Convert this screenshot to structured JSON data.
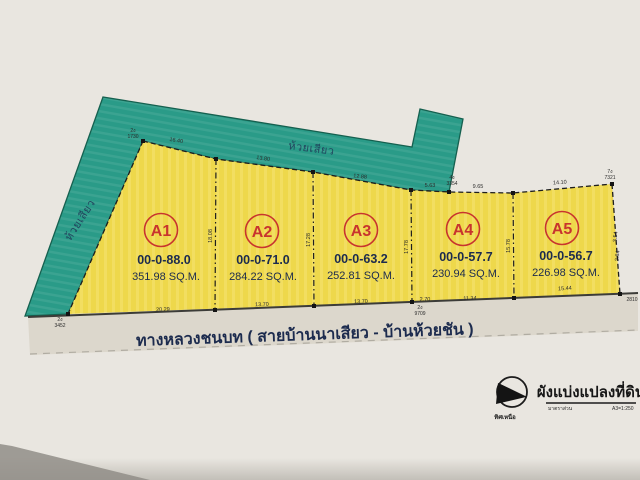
{
  "document": {
    "type_note": "scanned land subdivision plan",
    "stream_label_top": "ห้วยเสียว",
    "stream_label_left": "ห้วยเสียว",
    "road_label": "ทางหลวงชนบท ( สายบ้านนาเสียว - บ้านห้วยชัน )"
  },
  "plots": [
    {
      "id": "A1",
      "ratio": "00-0-88.0",
      "area": "351.98 SQ.M."
    },
    {
      "id": "A2",
      "ratio": "00-0-71.0",
      "area": "284.22 SQ.M."
    },
    {
      "id": "A3",
      "ratio": "00-0-63.2",
      "area": "252.81 SQ.M."
    },
    {
      "id": "A4",
      "ratio": "00-0-57.7",
      "area": "230.94 SQ.M."
    },
    {
      "id": "A5",
      "ratio": "00-0-56.7",
      "area": "226.98 SQ.M."
    }
  ],
  "measurements": {
    "top": [
      "16.40",
      "13.80",
      "12.88",
      "5.63",
      "9.65",
      "14.10"
    ],
    "bottom": [
      "20.29",
      "13.70",
      "13.70",
      "2.70",
      "11.34",
      "15.44"
    ],
    "side": [
      "18.08",
      "17.28",
      "17.78",
      "15.78",
      "3.54",
      "2.84"
    ],
    "points": [
      {
        "tag": "2ง",
        "num": "1730"
      },
      {
        "tag": "4ง",
        "num": "3354"
      },
      {
        "tag": "7ง",
        "num": "7321"
      },
      {
        "tag": "",
        "num": "2810"
      },
      {
        "tag": "2ง",
        "num": "9709"
      },
      {
        "tag": "2ง",
        "num": "3452"
      }
    ]
  },
  "title_block": {
    "title": "ผังแบ่งแปลงที่ดิน",
    "scale_label": "มาตราส่วน",
    "scale_value": "A3=1:250",
    "north_label": "ทิศเหนือ"
  },
  "colors": {
    "teal": "#2a9b88",
    "yellow": "#eed84b",
    "yellow_stripe": "#f5e472",
    "paper": "#e9e6e0",
    "road_band": "#dcd7cc",
    "red": "#c8342e",
    "navy": "#1c2b4e"
  }
}
